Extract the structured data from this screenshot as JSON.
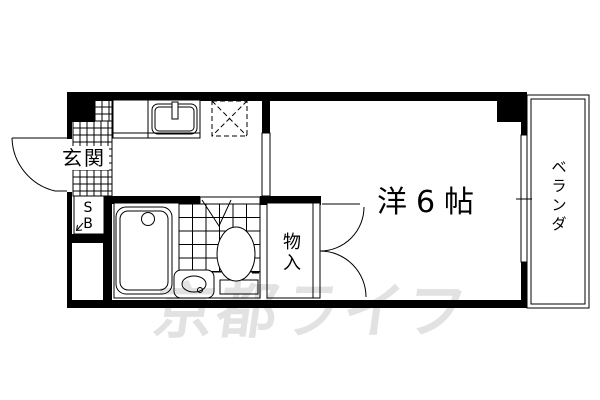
{
  "plan": {
    "entrance": {
      "label": "玄関"
    },
    "shoe_box": {
      "top": "S",
      "bottom": "B"
    },
    "main_room": {
      "label": "洋6帖"
    },
    "storage": {
      "label": "物入",
      "chars": [
        "物",
        "入"
      ]
    },
    "veranda": {
      "label": "ベランダ",
      "chars": [
        "ベ",
        "ラ",
        "ン",
        "ダ"
      ]
    },
    "watermark": {
      "text": "京都ライフ",
      "color": "#e2e2e2"
    },
    "colors": {
      "line": "#000000",
      "background": "#ffffff"
    }
  }
}
